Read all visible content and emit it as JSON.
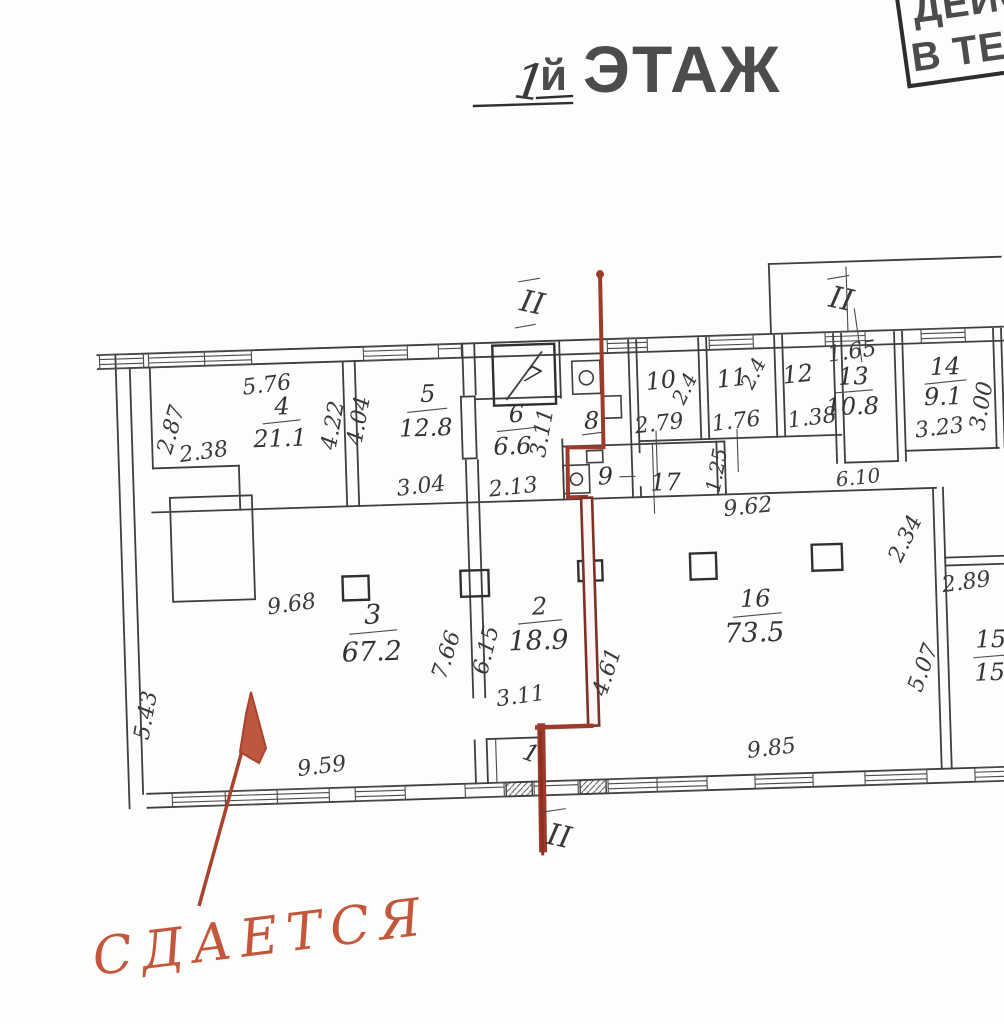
{
  "title": {
    "floor_number": "1",
    "floor_suffix": "й",
    "floor_word": "ЭТАЖ"
  },
  "stamp": {
    "line1": "ДЕЙС",
    "line2": "В ТЕЧ"
  },
  "handwritten_note": {
    "text": "СДАЕТСЯ"
  },
  "section_marks": {
    "top": "II",
    "top_right": "II",
    "bottom": "II"
  },
  "rooms": {
    "r1": {
      "number": "1"
    },
    "r2": {
      "number": "2",
      "area": "18.9"
    },
    "r3": {
      "number": "3",
      "area": "67.2"
    },
    "r4": {
      "number": "4",
      "area": "21.1"
    },
    "r5": {
      "number": "5",
      "area": "12.8"
    },
    "r6": {
      "number": "6",
      "area": "6.6"
    },
    "r7": {
      "number": "7"
    },
    "r8": {
      "number": "8"
    },
    "r9": {
      "number": "9"
    },
    "r10": {
      "number": "10"
    },
    "r11": {
      "number": "11"
    },
    "r12": {
      "number": "12"
    },
    "r13": {
      "number": "13",
      "area": "10.8"
    },
    "r14": {
      "number": "14",
      "area": "9.1"
    },
    "r15": {
      "number": "15",
      "area": "15"
    },
    "r16": {
      "number": "16",
      "area": "73.5"
    },
    "r17": {
      "number": "17"
    }
  },
  "dimensions": {
    "room4_top": "5.76",
    "room4_left": "2.87",
    "room4_notch": "2.38",
    "room4_right": "4.22",
    "room5_left": "4.04",
    "room5_bottom": "3.04",
    "room6_bottom": "2.13",
    "room6_left": "3.11",
    "room10_bottom": "2.79",
    "room10_side": "2.4",
    "room11_bottom": "1.76",
    "room11_side": "2.4",
    "room12_bottom": "1.38",
    "room13_top": "1.65",
    "corridor_right": "6.10",
    "corridor_width": "1.25",
    "room14_bottom": "3.23",
    "room14_right": "3.00",
    "room16_top": "9.62",
    "room16_side": "2.34",
    "room16_bottom": "9.85",
    "room15_top": "2.89",
    "room15_side": "5.07",
    "room3_top": "9.68",
    "room3_bottom": "9.59",
    "wall32_left": "7.66",
    "wall32_right": "6.15",
    "room2_door": "3.11",
    "room2_side": "4.61",
    "left_wall": "5.43"
  },
  "colors": {
    "pencil": "#3e3e3e",
    "red_marker": "#9c3a2c",
    "dark_red_wall": "#7c3127",
    "crayon": "#c4563c"
  }
}
